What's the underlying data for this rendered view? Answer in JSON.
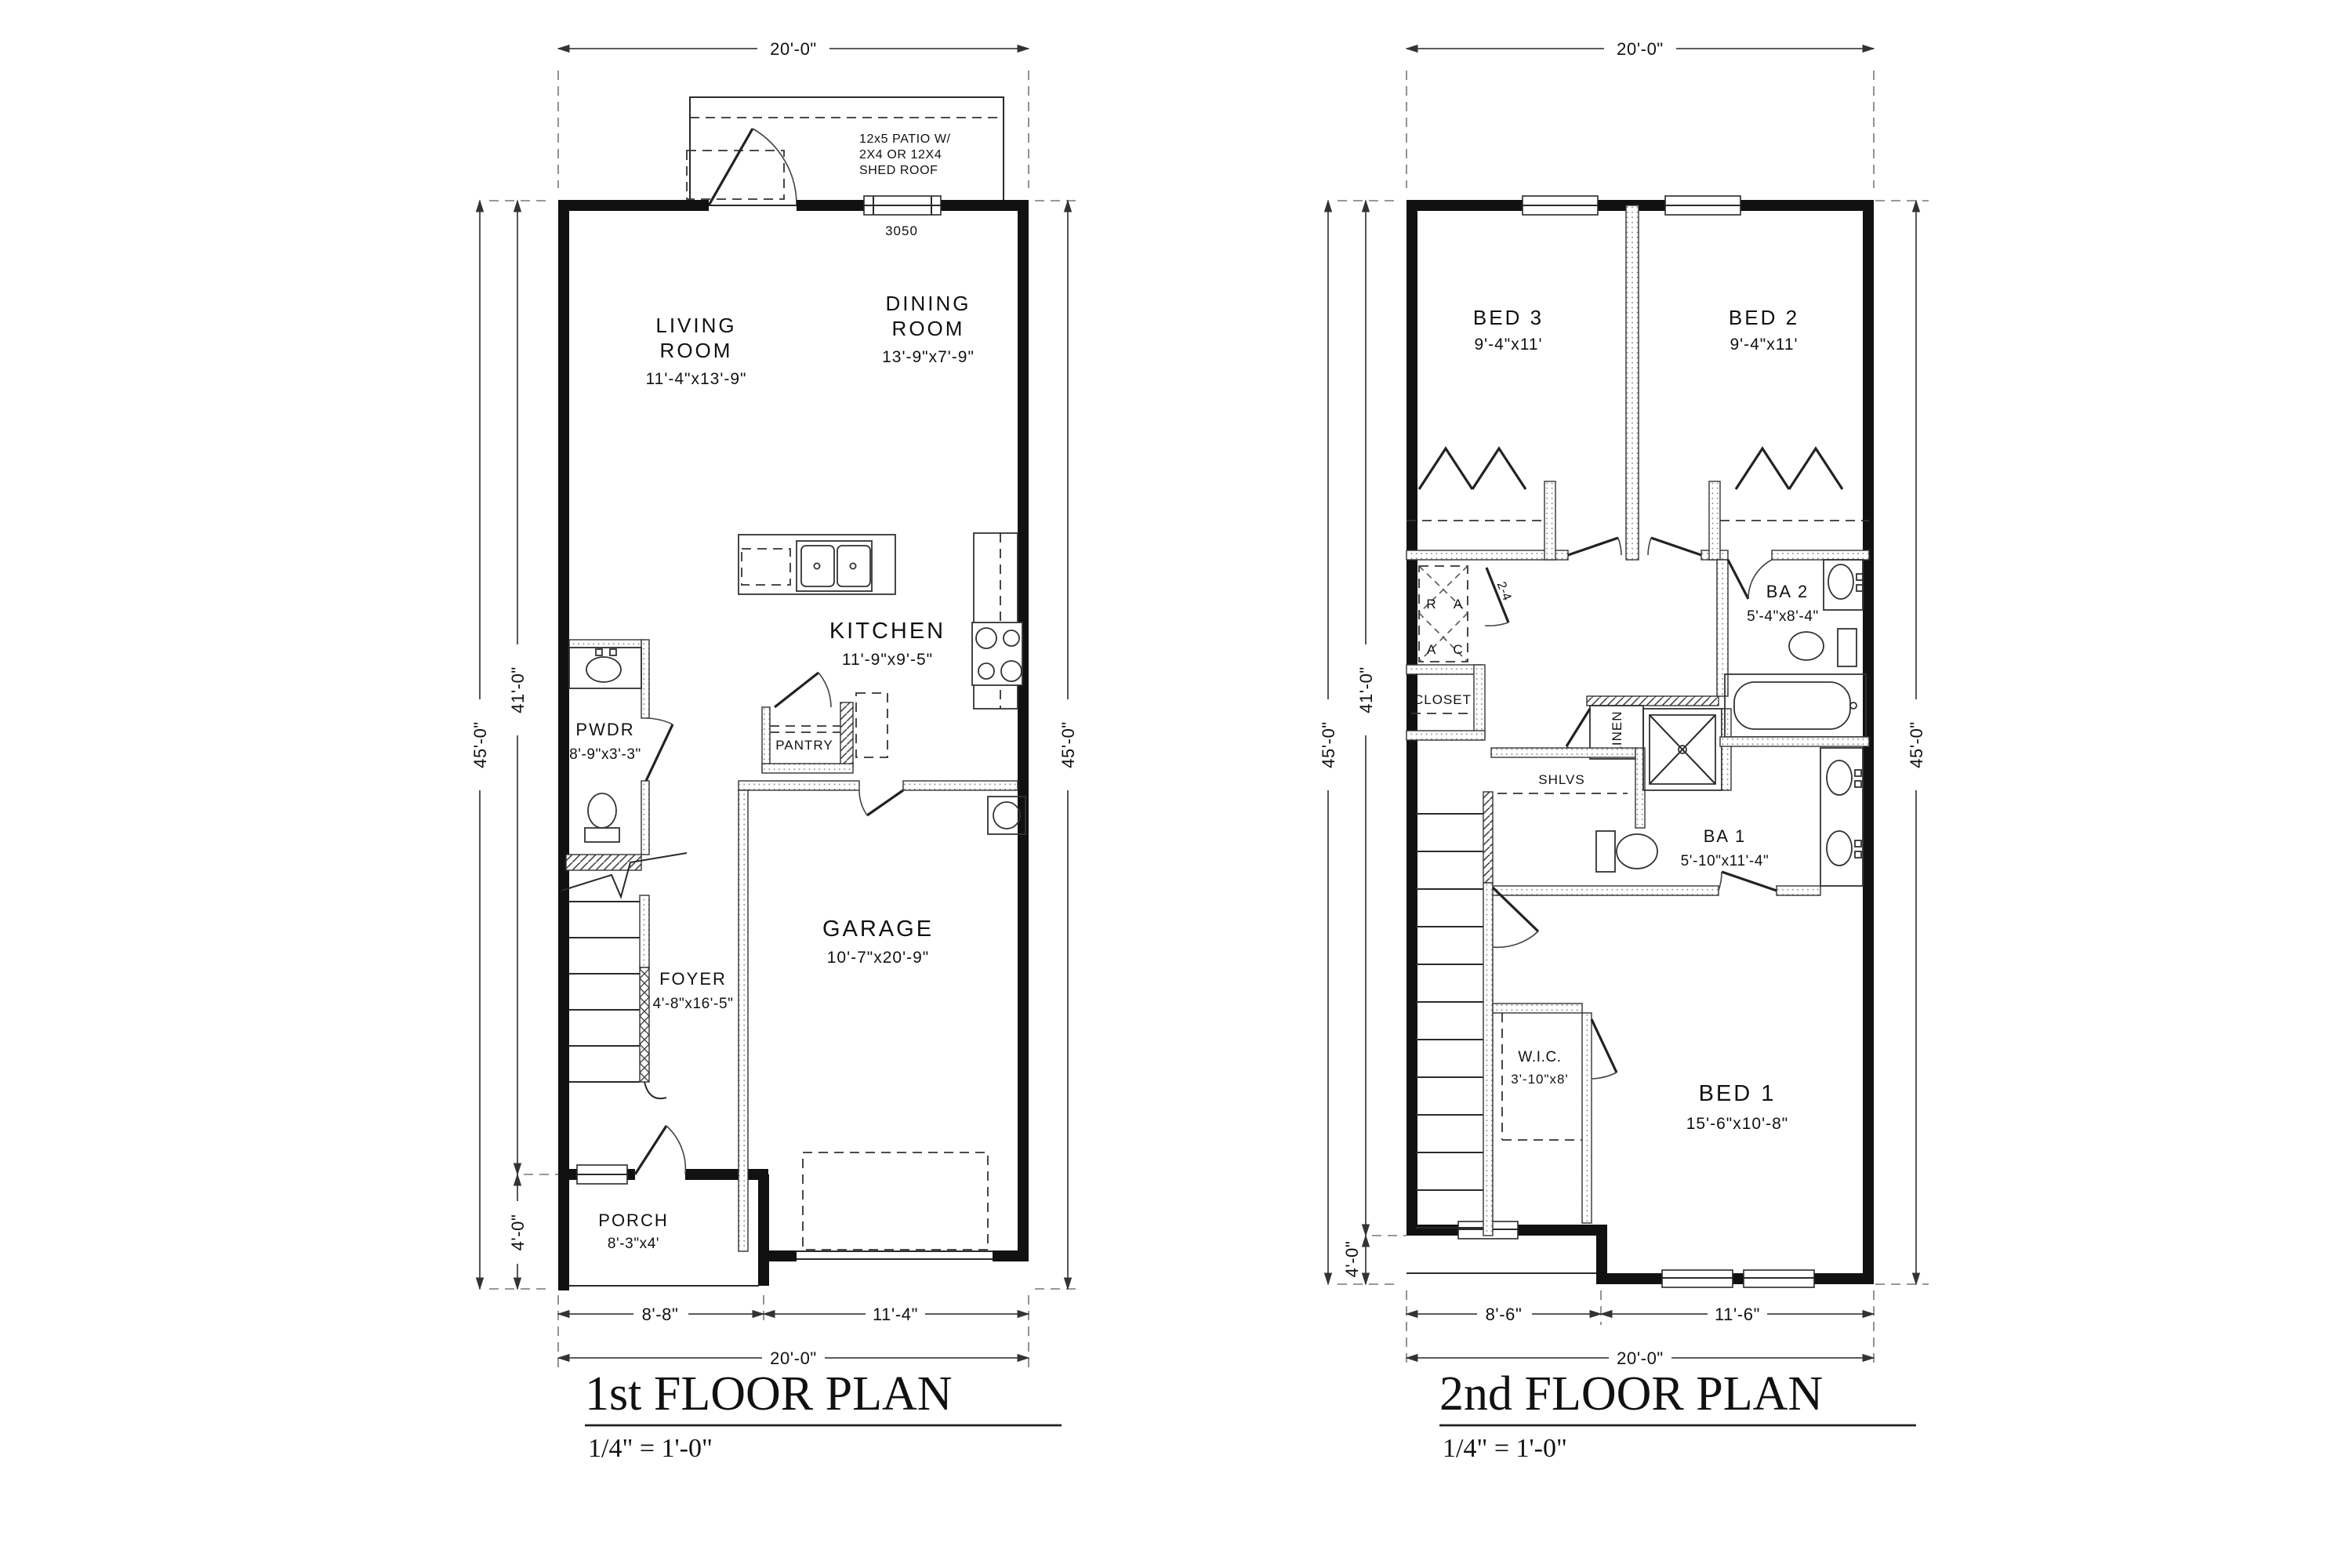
{
  "p1": {
    "title": "1st FLOOR PLAN",
    "scale": "1/4\" = 1'-0\"",
    "patio1": "12x5 PATIO W/",
    "patio2": "2X4 OR 12X4",
    "patio3": "SHED ROOF",
    "win": "3050",
    "living1": "LIVING",
    "living2": "ROOM",
    "living3": "11'-4\"x13'-9\"",
    "dining1": "DINING",
    "dining2": "ROOM",
    "dining3": "13'-9\"x7'-9\"",
    "kitchen1": "KITCHEN",
    "kitchen2": "11'-9\"x9'-5\"",
    "pwdr1": "PWDR",
    "pwdr2": "8'-9\"x3'-3\"",
    "pantry": "PANTRY",
    "foyer1": "FOYER",
    "foyer2": "4'-8\"x16'-5\"",
    "garage1": "GARAGE",
    "garage2": "10'-7\"x20'-9\"",
    "porch1": "PORCH",
    "porch2": "8'-3\"x4'",
    "dim_top": "20'-0\"",
    "dim_left": "45'-0\"",
    "dim_left2": "41'-0\"",
    "dim_left3": "4'-0\"",
    "dim_right": "45'-0\"",
    "dim_b1": "8'-8\"",
    "dim_b2": "11'-4\"",
    "dim_b3": "20'-0\""
  },
  "p2": {
    "title": "2nd FLOOR PLAN",
    "scale": "1/4\" = 1'-0\"",
    "bed3a": "BED 3",
    "bed3b": "9'-4\"x11'",
    "bed2a": "BED 2",
    "bed2b": "9'-4\"x11'",
    "ba2a": "BA 2",
    "ba2b": "5'-4\"x8'-4\"",
    "ba1a": "BA 1",
    "ba1b": "5'-10\"x11'-4\"",
    "bed1a": "BED 1",
    "bed1b": "15'-6\"x10'-8\"",
    "wica": "W.I.C.",
    "wicb": "3'-10\"x8'",
    "closet": "CLOSET",
    "linen": "LINEN",
    "shlvs": "SHLVS",
    "hv1": "R",
    "hv2": "A",
    "hv3": "A",
    "hv4": "C",
    "doortag": "2-4",
    "dim_top": "20'-0\"",
    "dim_left": "45'-0\"",
    "dim_left2": "41'-0\"",
    "dim_left3": "4'-0\"",
    "dim_right": "45'-0\"",
    "dim_b1": "8'-6\"",
    "dim_b2": "11'-6\"",
    "dim_b3": "20'-0\""
  }
}
